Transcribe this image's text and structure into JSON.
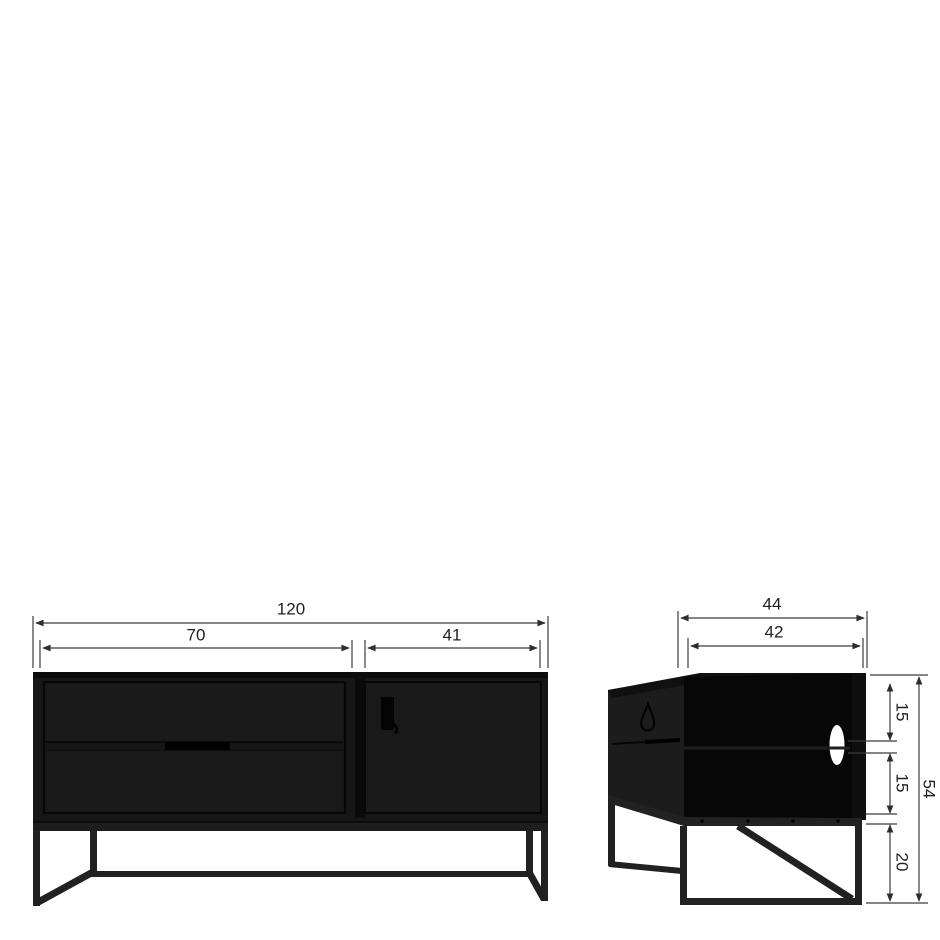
{
  "front_view": {
    "dims": {
      "total_width": "120",
      "drawer_section_width": "70",
      "door_section_width": "41"
    }
  },
  "side_view": {
    "dims": {
      "total_depth": "44",
      "inner_depth": "42",
      "upper_compartment_height": "15",
      "lower_compartment_height": "15",
      "leg_height": "20",
      "total_height": "54"
    }
  },
  "colors": {
    "background": "#ffffff",
    "furniture_black": "#161616",
    "metal_frame": "#212121",
    "dimension_line": "#3c3c3c",
    "text": "#1f1f1f",
    "cable_hole": "#ffffff"
  }
}
